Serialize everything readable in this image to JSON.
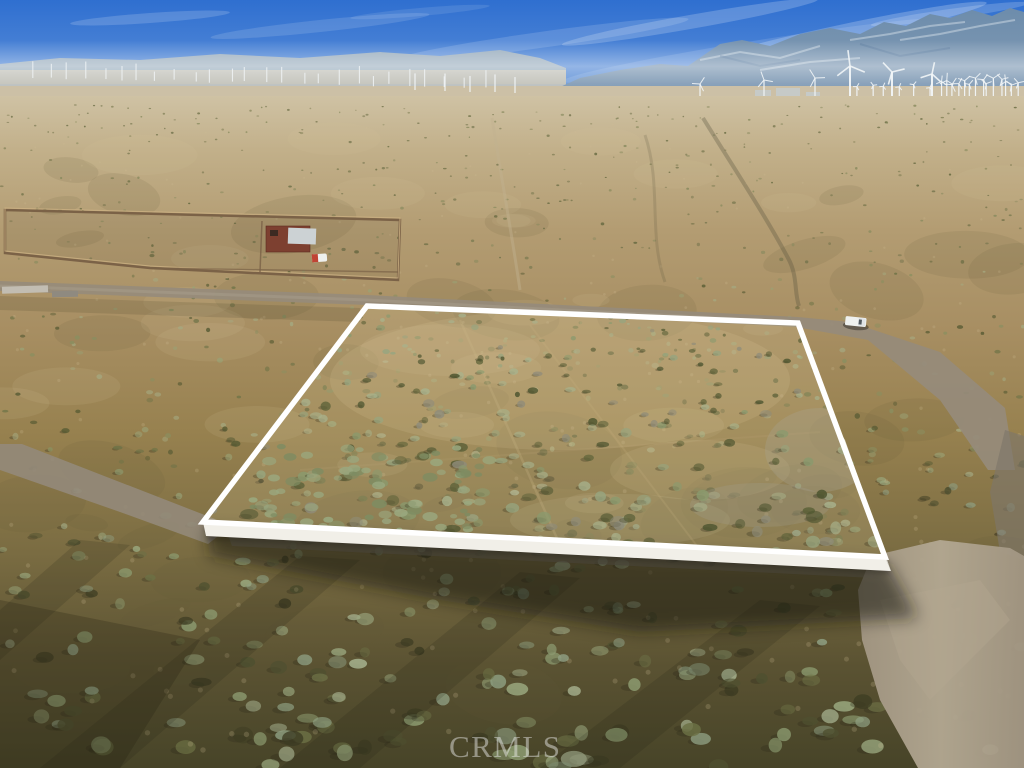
{
  "watermark": {
    "label": "CRMLS"
  },
  "scene": {
    "name": "aerial-desert-land-parcel-listing-photo",
    "objects": {
      "parcel_boundary": "white-outlined vacant land parcel",
      "truck": "white pickup truck on dirt road",
      "compound": "fenced lot with red structure and white roof",
      "wind_farm": "wind turbines and substation along horizon",
      "mountains": "hazy blue mountain range"
    },
    "colors": {
      "sky_top": "#2f6fd0",
      "sky_mid": "#4f86d6",
      "sky_horizon": "#b4cbdf",
      "cloud": "#ffffff",
      "hills_left": "#9db0c0",
      "mountain_top": "#6d8cab",
      "mountain_base": "#8aa2ba",
      "snow": "#dde6ee",
      "foothill_brown": "#97876f",
      "far_ridge": "#8b96a0",
      "desert_far": "#cfc2a4",
      "desert_mid": "#a78e62",
      "desert_near": "#7a6c42",
      "desert_dark": "#474428",
      "mottle_dark": "#63593c",
      "mottle_light": "#d8c79e",
      "road": "#968b7b",
      "road_light": "#a79d8c",
      "road_bright": "#a29683",
      "road_bright_core": "#b3a892",
      "shadow": "#15130d",
      "band_shadow": "#221e10",
      "turbine": "#f2f6f8",
      "substation_box": "#d6dad6",
      "rail_dark": "#443931",
      "fence": "#7b6247",
      "fence_light": "#cdb183",
      "building_red": "#7d4030",
      "building_roof": "#ccd2d4",
      "vehicle_red": "#c04434",
      "truck_body": "#eef0ee",
      "truck_cab": "#dfe3e6",
      "truck_glass": "#3a4248",
      "parcel_outline": "#ffffff",
      "parcel_slab": "#f1efe8",
      "parcel_tint": "#d9c79a",
      "wash_dark": "#514c38",
      "trail_light": "#c2b190",
      "watermark_color": "rgba(235,235,235,0.48)"
    }
  }
}
